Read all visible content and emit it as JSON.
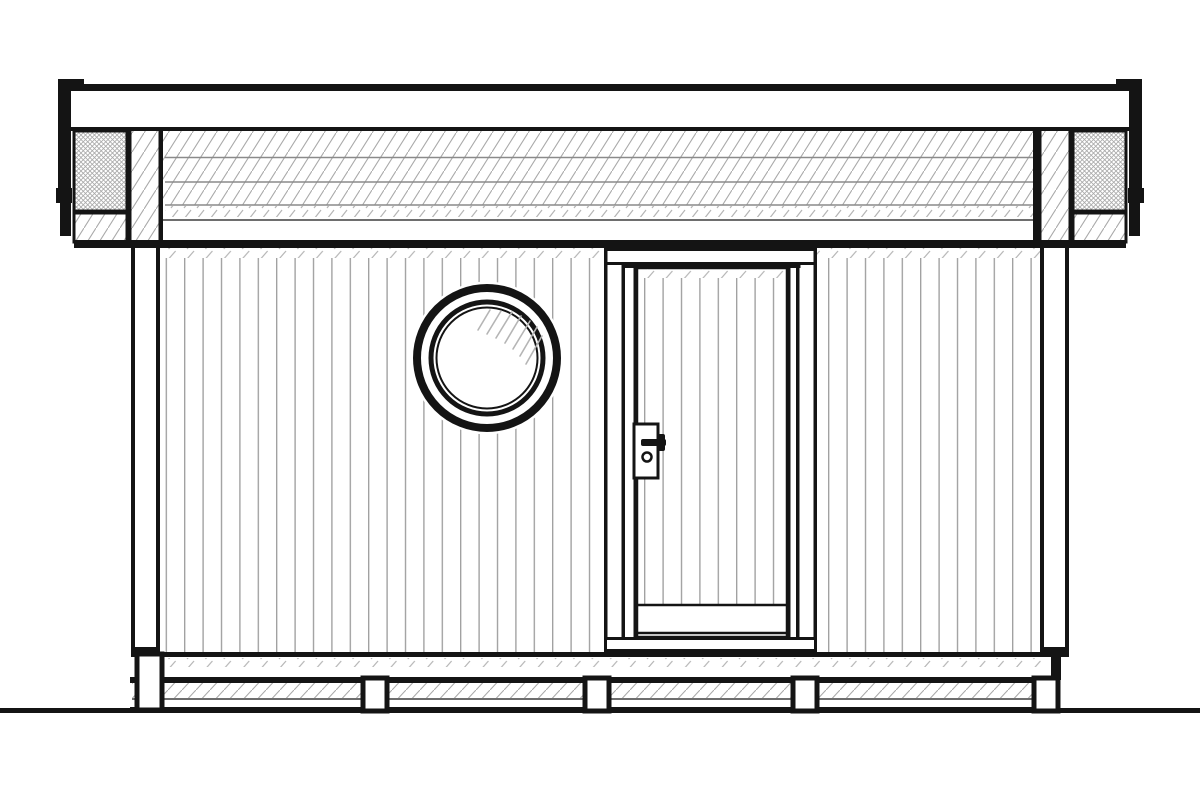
{
  "drawing": {
    "kind": "architectural front elevation, black line drawing on white",
    "components": [
      "flat roof with fascia",
      "gutter end caps",
      "vertical board siding wall",
      "round porthole window",
      "single entry door with lever handle",
      "foundation beam on posts",
      "ground line"
    ]
  },
  "colors": {
    "background": "#ffffff",
    "ink": "#141414",
    "hatch": "#a9a9a9",
    "siding_line": "#9c9c9c",
    "divider": "#8a8a8a",
    "tick": "#b5b5b5",
    "thin_line": "#6e6e6e"
  },
  "canvas": {
    "width": 1200,
    "height": 800
  },
  "roof": {
    "cap_y": 84,
    "cap_left": 58,
    "cap_right": 1142,
    "fascia_hatch_top": 131,
    "fascia_hatch_bottom": 205,
    "divider_ys": [
      157.5,
      182,
      205
    ],
    "hatch_spacing": 12,
    "ticks_spacing": 13,
    "thin_line_y": 219,
    "soffit_bottom": 240
  },
  "wall": {
    "left": 131,
    "right": 1069,
    "top_band_y": 240,
    "bottom_line_y": 652,
    "siding_spacing": 18.4,
    "siding_left": 160,
    "siding_right": 1040
  },
  "porthole": {
    "cx": 487,
    "cy": 358,
    "mask_r": 76.5,
    "outer_r": 70,
    "outer_stroke": 8,
    "mid_r": 56,
    "mid_stroke": 5,
    "inner_r": 50.5,
    "inner_stroke": 2,
    "glass_ticks": [
      [
        478,
        330,
        490,
        310
      ],
      [
        487,
        334,
        501,
        311
      ],
      [
        496,
        338,
        512,
        312
      ],
      [
        505,
        343,
        521,
        316
      ],
      [
        513,
        349,
        530,
        321
      ],
      [
        520,
        356,
        537,
        327
      ],
      [
        526,
        364,
        542,
        336
      ]
    ]
  },
  "door": {
    "left": 604,
    "right": 817,
    "top": 248,
    "head_bottom": 264,
    "leaf_left": 637,
    "leaf_right": 787,
    "leaf_top": 268,
    "rail_top": 605,
    "rail_h": 28,
    "sill_top": 637,
    "bottom": 652,
    "handle": {
      "plate_x": 634,
      "plate_y": 424,
      "plate_w": 24,
      "plate_h": 54,
      "keyhole_cx": 647,
      "keyhole_cy": 457,
      "keyhole_r": 4.5
    }
  },
  "foundation": {
    "beam_left": 130,
    "beam_right": 1058,
    "beam_top": 677,
    "hatch_top": 683,
    "hatch_bottom": 698,
    "ground_y": 708,
    "ground_h": 5,
    "posts": [
      {
        "x": 137,
        "y": 654,
        "w": 25,
        "h": 56
      },
      {
        "x": 363,
        "y": 678,
        "w": 24,
        "h": 33
      },
      {
        "x": 585,
        "y": 678,
        "w": 24,
        "h": 33
      },
      {
        "x": 793,
        "y": 678,
        "w": 24,
        "h": 33
      },
      {
        "x": 1034,
        "y": 678,
        "w": 24,
        "h": 33
      }
    ]
  }
}
